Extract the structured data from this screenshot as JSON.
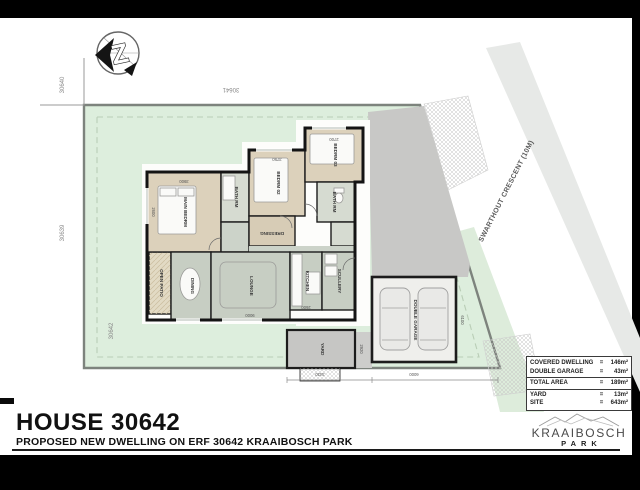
{
  "title": {
    "house": "HOUSE 30642",
    "subtitle": "PROPOSED NEW DWELLING ON ERF 30642 KRAAIBOSCH PARK"
  },
  "compass": {
    "letter": "Z"
  },
  "street": {
    "name": "SWARTHOUT CRESCENT (10M)"
  },
  "parcels": {
    "left_top": "30640",
    "left_mid": "30639",
    "site": "30642",
    "top": "30641"
  },
  "rooms": {
    "main_bedrm": "MAIN BEDRM",
    "bath_main": "BATH RM",
    "bedrm02": "BEDRM 02",
    "bedrm03": "BEDRM 03",
    "bath2": "BATH RM",
    "dressing": "DRESSING",
    "open_patio": "OPEN PATIO",
    "dining": "DINING",
    "lounge": "LOUNGE",
    "kitchen": "KITCHEN",
    "scullery": "SCULLERY",
    "yard": "YARD",
    "garage": "DOUBLE GARAGE"
  },
  "dims": {
    "d1": "3900",
    "d2": "2600",
    "d3": "3750",
    "d4": "2700",
    "d5": "9000",
    "d6": "2600",
    "d7": "6100",
    "d8": "6000",
    "d9": "3430",
    "d10": "2920"
  },
  "areas": {
    "eq": "=",
    "rows": [
      {
        "label": "COVERED DWELLING",
        "value": "146m²"
      },
      {
        "label": "DOUBLE GARAGE",
        "value": "43m²"
      },
      {
        "label": "TOTAL AREA",
        "value": "189m²"
      },
      {
        "label": "YARD",
        "value": "13m²"
      },
      {
        "label": "SITE",
        "value": "643m²"
      }
    ]
  },
  "logo": {
    "name": "KRAAIBOSCH",
    "sub": "PARK"
  },
  "colors": {
    "site_green": "#ddeedd",
    "room_beige": "#dcd1bb",
    "floor_sage": "#c7cec3",
    "driveway_gray": "#c8c8c6",
    "wall_black": "#141414"
  }
}
